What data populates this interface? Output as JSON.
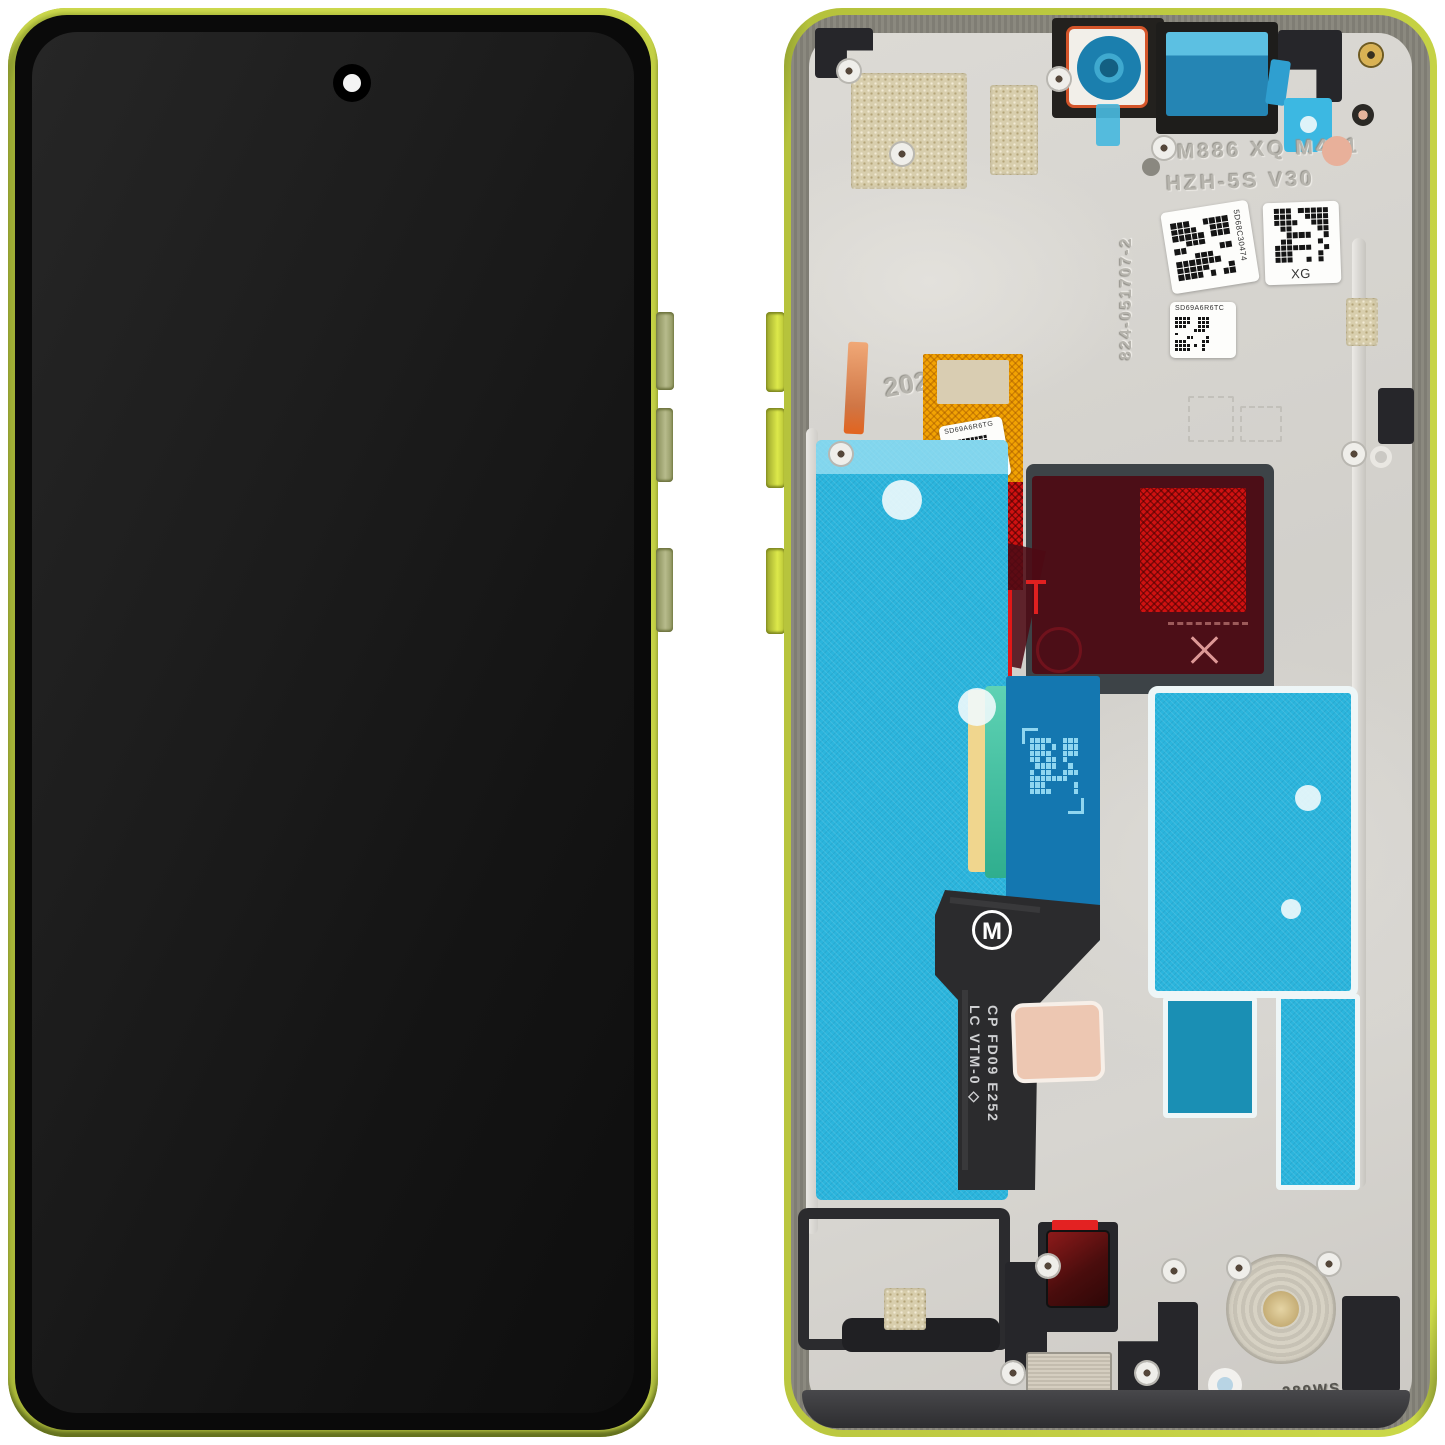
{
  "photo": {
    "background": "#ffffff"
  },
  "front": {
    "frame_color": "#b8c43e",
    "screen_color": "#141414"
  },
  "back": {
    "engravings": {
      "model_line1": "SM886 XQ M441",
      "model_line2": "HZH-5S V30",
      "part_number": "824-051707-2",
      "year": "2025",
      "bottom_code": "289WS"
    },
    "stickers": {
      "qr_label_1": "5D68C30474",
      "qr_label_2": "XG",
      "qr_label_3": "SD69A6R6TC",
      "qr_label_4": "SD69A6R6TG"
    },
    "flex": {
      "logo_letter": "M",
      "marking_line1": "CP FD09 E252",
      "marking_line2": "LC VTM-0 ◇"
    },
    "colors": {
      "frame_lime": "#b8c43e",
      "bezel_gray": "#85837b",
      "plate_silver": "#d6d4d0",
      "adhesive_cyan": "#2bb5dd",
      "flex_blue": "#1477b0",
      "flex_orange": "#f2a303",
      "adhesive_red": "#cf1111",
      "film_dark_red": "#4d0a14",
      "copper_tab": "#dd8a5a",
      "mesh_gold": "#d8cead",
      "pad_pink": "#edc7b2",
      "strip_teal": "#3fc9a9",
      "strip_yellow": "#f0d68e",
      "camera_blue": "#2a96c2"
    }
  }
}
